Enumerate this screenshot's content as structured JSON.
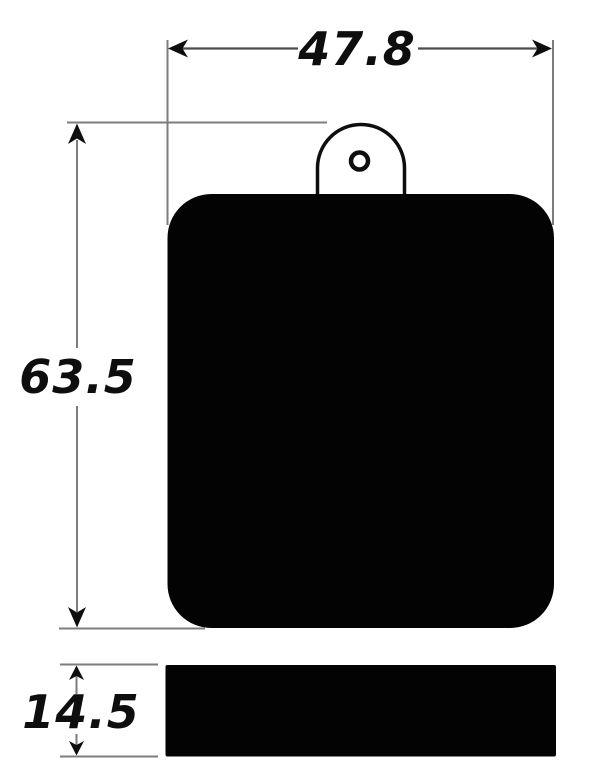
{
  "drawing": {
    "dimensions": {
      "width": {
        "label": "47.8"
      },
      "height": {
        "label": "63.5"
      },
      "thickness": {
        "label": "14.5"
      }
    },
    "colors": {
      "ink": "#0e0e0e",
      "extension_line": "#7d7d7d",
      "dimension_line": "#4c4c4c",
      "part_fill": "#030303",
      "background": "#ffffff"
    }
  }
}
